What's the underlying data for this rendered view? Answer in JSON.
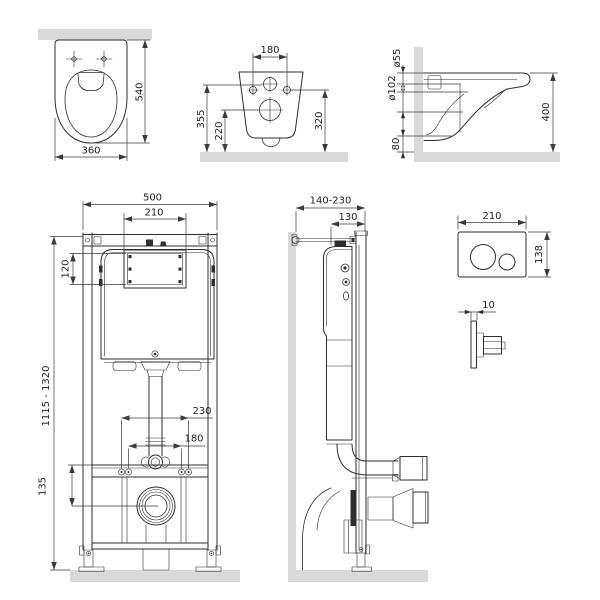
{
  "colors": {
    "line": "#2e2e2e",
    "dimension": "#3a3a3a",
    "wall_fill": "#d9d9d9",
    "background": "#ffffff"
  },
  "views": {
    "toilet_top_view": {
      "depth_mm": "540",
      "width_mm": "360"
    },
    "toilet_rear_view": {
      "bolt_spacing_mm": "180",
      "inlet_height_mm": "355",
      "outlet_height_mm": "220",
      "bolt_height_mm": "320"
    },
    "toilet_side_view": {
      "flush_pipe_diameter": "ø55",
      "outlet_pipe_diameter": "ø102",
      "outlet_clearance_mm": "80",
      "rim_height_mm": "400"
    },
    "frame_front_view": {
      "frame_width_mm": "500",
      "window_width_mm": "210",
      "window_height_mm": "120",
      "frame_height_mm": "1115 - 1320",
      "outer_bolt_spacing_mm": "230",
      "inner_bolt_spacing_mm": "180",
      "outlet_center_height_mm": "135"
    },
    "frame_side_view": {
      "depth_range_mm": "140-230",
      "frame_depth_mm": "130"
    },
    "flush_plate": {
      "width_mm": "210",
      "height_mm": "138",
      "thickness_mm": "10"
    }
  }
}
